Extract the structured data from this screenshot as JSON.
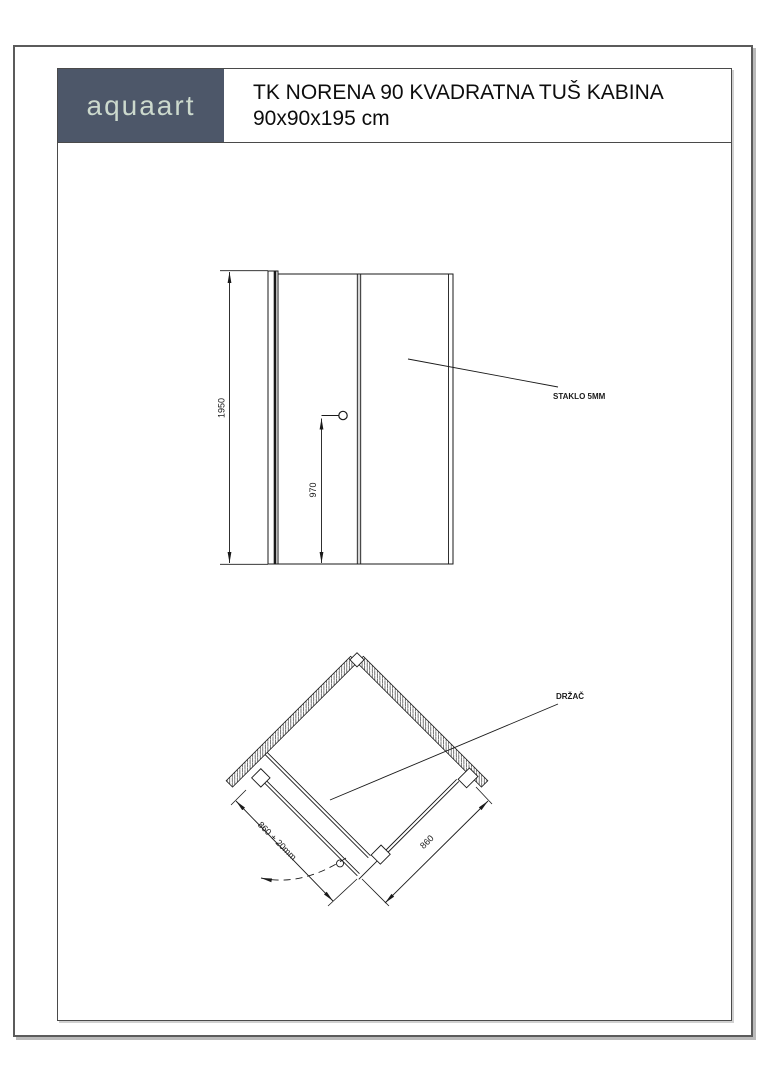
{
  "header": {
    "brand": "aquaart",
    "title_line1": "TK NORENA 90 KVADRATNA TUŠ KABINA",
    "title_line2": "90x90x195 cm",
    "brand_bg": "#4d5769",
    "brand_color": "#ccd9cd"
  },
  "front_view": {
    "overall_height_mm": "1950",
    "handle_height_mm": "970",
    "glass_label": "STAKLO 5MM"
  },
  "plan_view": {
    "door_side_dim": "860 + 20mm",
    "fixed_side_dim": "860",
    "handle_label": "DRŽAČ"
  }
}
